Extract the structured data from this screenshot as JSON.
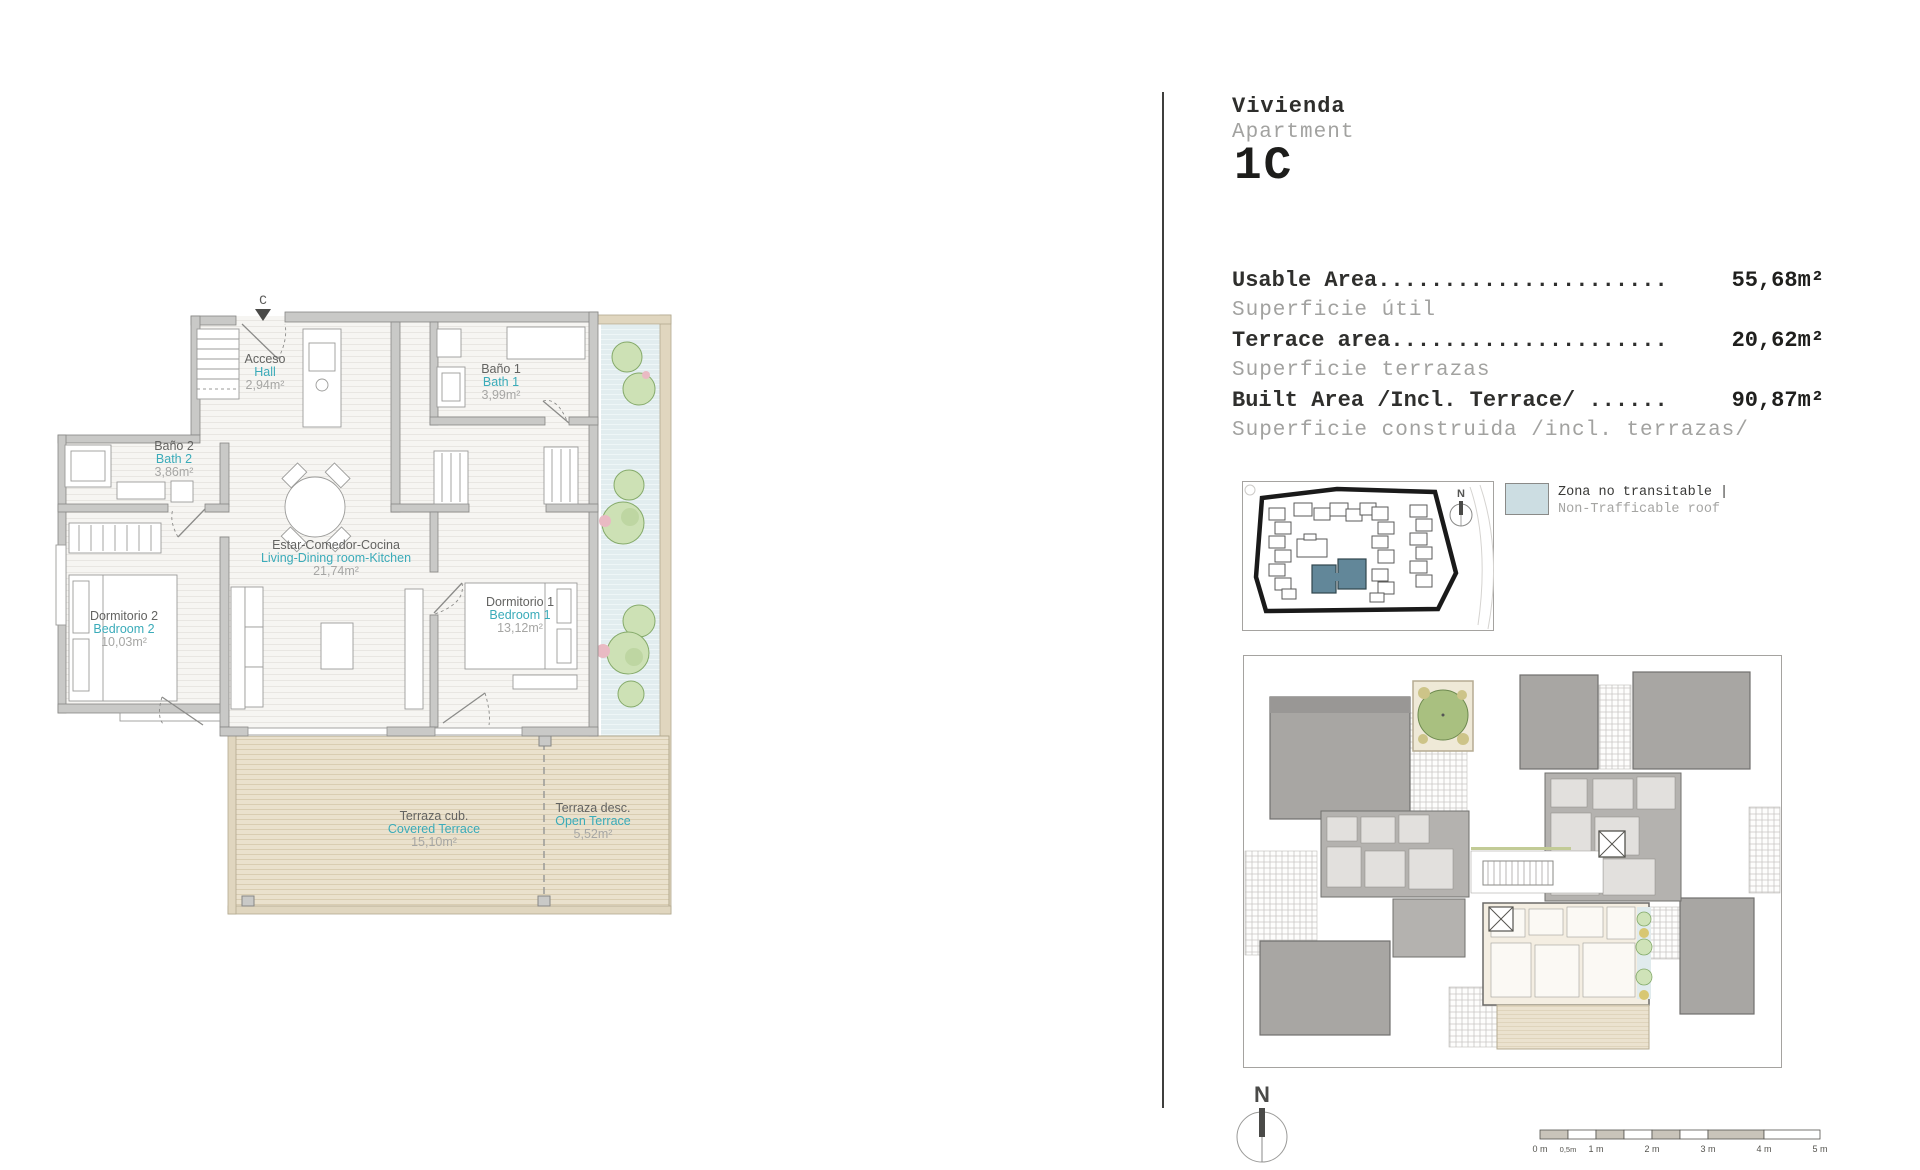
{
  "header": {
    "title_es": "Vivienda",
    "title_en": "Apartment",
    "unit_number": "1C"
  },
  "area_table": {
    "rows": [
      {
        "label_en": "Usable Area......................",
        "label_es": "Superficie útil",
        "value": "55,68",
        "unit": "m²"
      },
      {
        "label_en": "Terrace area.....................",
        "label_es": "Superficie terrazas",
        "value": "20,62",
        "unit": "m²"
      },
      {
        "label_en": "Built Area /Incl. Terrace/ ......",
        "label_es": "Superficie construida /incl. terrazas/",
        "value": "90,87",
        "unit": "m²"
      }
    ]
  },
  "legend": {
    "label_es": "Zona no transitable |",
    "label_en": "Non-Trafficable roof",
    "swatch_color": "#ccdde2"
  },
  "floor_plan": {
    "section_marker": "C",
    "rooms": [
      {
        "name_es": "Acceso",
        "name_en": "Hall",
        "area": "2,94m²"
      },
      {
        "name_es": "Baño 1",
        "name_en": "Bath 1",
        "area": "3,99m²"
      },
      {
        "name_es": "Baño 2",
        "name_en": "Bath 2",
        "area": "3,86m²"
      },
      {
        "name_es": "Estar-Comedor-Cocina",
        "name_en": "Living-Dining room-Kitchen",
        "area": "21,74m²"
      },
      {
        "name_es": "Dormitorio 2",
        "name_en": "Bedroom 2",
        "area": "10,03m²"
      },
      {
        "name_es": "Dormitorio 1",
        "name_en": "Bedroom 1",
        "area": "13,12m²"
      },
      {
        "name_es": "Terraza cub.",
        "name_en": "Covered Terrace",
        "area": "15,10m²"
      },
      {
        "name_es": "Terraza desc.",
        "name_en": "Open Terrace",
        "area": "5,52m²"
      }
    ]
  },
  "site_plan": {
    "north_label": "N"
  },
  "compass": {
    "north_label": "N"
  },
  "scale_bar": {
    "labels": [
      "0 m",
      "0,5m",
      "1 m",
      "2 m",
      "3 m",
      "4 m",
      "5 m"
    ]
  },
  "colors": {
    "accent_teal": "#3aabb9",
    "wall_gray": "#c9c9c7",
    "terrace_beige": "#eae1cd",
    "non_trafficable_blue": "#e2edef",
    "site_highlight_building": "#628799",
    "divider": "#3f3f3d"
  }
}
